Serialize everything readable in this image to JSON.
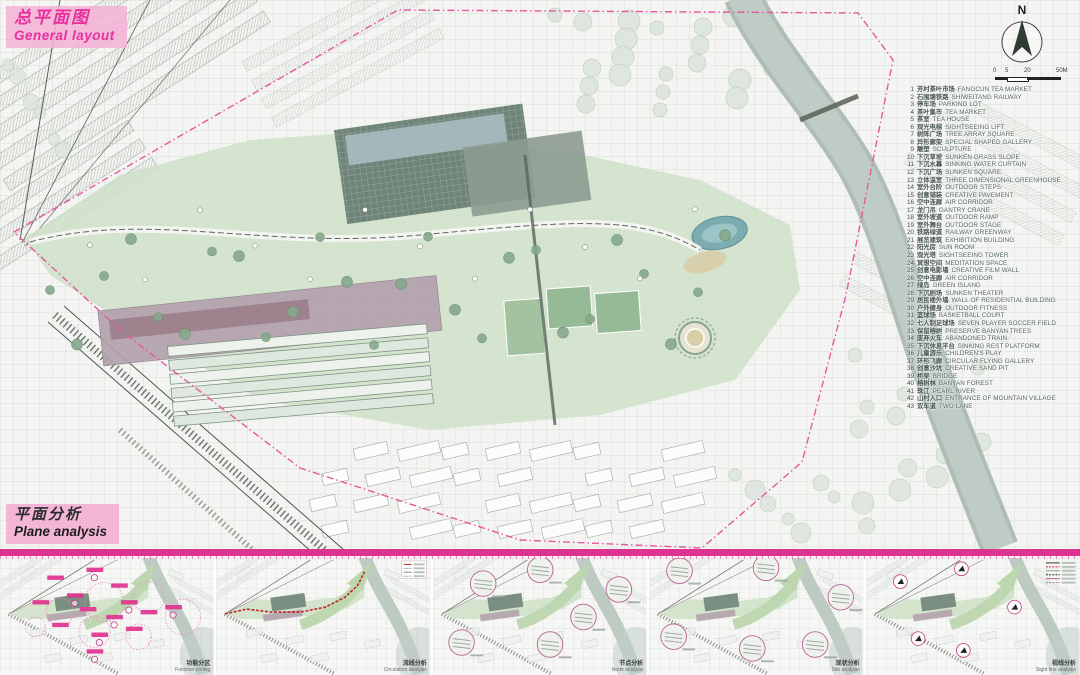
{
  "poster": {
    "title_zh": "总平面图",
    "title_en": "General layout",
    "analysis_title_zh": "平面分析",
    "analysis_title_en": "Plane analysis",
    "north_label": "N",
    "scale_labels": [
      "0",
      "5",
      "20",
      "50M"
    ]
  },
  "legend": {
    "items": [
      {
        "num": "1",
        "zh": "芳村茶叶市场",
        "en": "FANGCUN TEA MARKET"
      },
      {
        "num": "2",
        "zh": "石围塘铁路",
        "en": "SHIWEITANG RAILWAY"
      },
      {
        "num": "3",
        "zh": "停车场",
        "en": "PARKING LOT"
      },
      {
        "num": "4",
        "zh": "茶叶集市",
        "en": "TEA MARKET"
      },
      {
        "num": "5",
        "zh": "茶室",
        "en": "TEA HOUSE"
      },
      {
        "num": "6",
        "zh": "观光电梯",
        "en": "SIGHTSEEING LIFT"
      },
      {
        "num": "7",
        "zh": "树阵广场",
        "en": "TREE ARRAY SQUARE"
      },
      {
        "num": "8",
        "zh": "异形廊架",
        "en": "SPECIAL SHAPED GALLERY"
      },
      {
        "num": "9",
        "zh": "雕塑",
        "en": "SCULPTURE"
      },
      {
        "num": "10",
        "zh": "下沉草坡",
        "en": "SUNKEN GRASS SLOPE"
      },
      {
        "num": "11",
        "zh": "下沉水幕",
        "en": "SINKING WATER CURTAIN"
      },
      {
        "num": "12",
        "zh": "下沉广场",
        "en": "SUNKEN SQUARE"
      },
      {
        "num": "13",
        "zh": "立体温室",
        "en": "THREE DIMENSIONAL GREENHOUSE"
      },
      {
        "num": "14",
        "zh": "室外台阶",
        "en": "OUTDOOR STEPS"
      },
      {
        "num": "15",
        "zh": "创意铺装",
        "en": "CREATIVE PAVEMENT"
      },
      {
        "num": "16",
        "zh": "空中连廊",
        "en": "AIR CORRIDOR"
      },
      {
        "num": "17",
        "zh": "龙门吊",
        "en": "GANTRY CRANE"
      },
      {
        "num": "18",
        "zh": "室外坡道",
        "en": "OUTDOOR RAMP"
      },
      {
        "num": "19",
        "zh": "室外舞台",
        "en": "OUTDOOR STAGE"
      },
      {
        "num": "20",
        "zh": "铁路绿道",
        "en": "RAILWAY GREENWAY"
      },
      {
        "num": "21",
        "zh": "展览建筑",
        "en": "EXHIBITION BUILDING"
      },
      {
        "num": "22",
        "zh": "阳光房",
        "en": "SUN ROOM"
      },
      {
        "num": "23",
        "zh": "观光塔",
        "en": "SIGHTSEEING TOWER"
      },
      {
        "num": "24",
        "zh": "冥想空间",
        "en": "MEDITATION SPACE"
      },
      {
        "num": "25",
        "zh": "创意电影墙",
        "en": "CREATIVE FILM WALL"
      },
      {
        "num": "26",
        "zh": "空中连廊",
        "en": "AIR CORRIDOR"
      },
      {
        "num": "27",
        "zh": "绿岛",
        "en": "GREEN ISLAND"
      },
      {
        "num": "28",
        "zh": "下沉剧场",
        "en": "SUNKEN THEATER"
      },
      {
        "num": "29",
        "zh": "居民楼外墙",
        "en": "WALL OF RESIDENTIAL BUILDING"
      },
      {
        "num": "30",
        "zh": "户外健身",
        "en": "OUTDOOR FITNESS"
      },
      {
        "num": "31",
        "zh": "篮球场",
        "en": "BASKETBALL COURT"
      },
      {
        "num": "32",
        "zh": "七人制足球场",
        "en": "SEVEN PLAYER SOCCER FIELD"
      },
      {
        "num": "33",
        "zh": "保留榕树",
        "en": "PRESERVE BANYAN TREES"
      },
      {
        "num": "34",
        "zh": "废弃火车",
        "en": "ABANDONED TRAIN"
      },
      {
        "num": "35",
        "zh": "下沉休息平台",
        "en": "SINKING REST PLATFORM"
      },
      {
        "num": "36",
        "zh": "儿童游乐",
        "en": "CHILDREN'S PLAY"
      },
      {
        "num": "37",
        "zh": "环形飞廊",
        "en": "CIRCULAR FLYING GALLERY"
      },
      {
        "num": "38",
        "zh": "创意沙坑",
        "en": "CREATIVE SAND PIT"
      },
      {
        "num": "39",
        "zh": "桥梁",
        "en": "BRIDGE"
      },
      {
        "num": "40",
        "zh": "榕树林",
        "en": "BANYAN FOREST"
      },
      {
        "num": "41",
        "zh": "珠江",
        "en": "PEARL RIVER"
      },
      {
        "num": "42",
        "zh": "山村入口",
        "en": "ENTRANCE OF MOUNTAIN VILLAGE"
      },
      {
        "num": "43",
        "zh": "双车道",
        "en": "TWO LANE"
      }
    ]
  },
  "panels": [
    {
      "caption_zh": "功能分区",
      "caption_en": "Function zoning"
    },
    {
      "caption_zh": "流线分析",
      "caption_en": "Circulation analysis"
    },
    {
      "caption_zh": "节点分析",
      "caption_en": "Node analysis"
    },
    {
      "caption_zh": "现状分析",
      "caption_en": "Site analysis"
    },
    {
      "caption_zh": "视线分析",
      "caption_en": "Sight line analysis"
    }
  ],
  "colors": {
    "accent_pink": "#e0338f",
    "title_pink": "#e8309f",
    "river": "#b7c5be",
    "park_green": "#cfe0c8",
    "dark_roof": "#6e8478",
    "legend_text": "#44544c"
  }
}
